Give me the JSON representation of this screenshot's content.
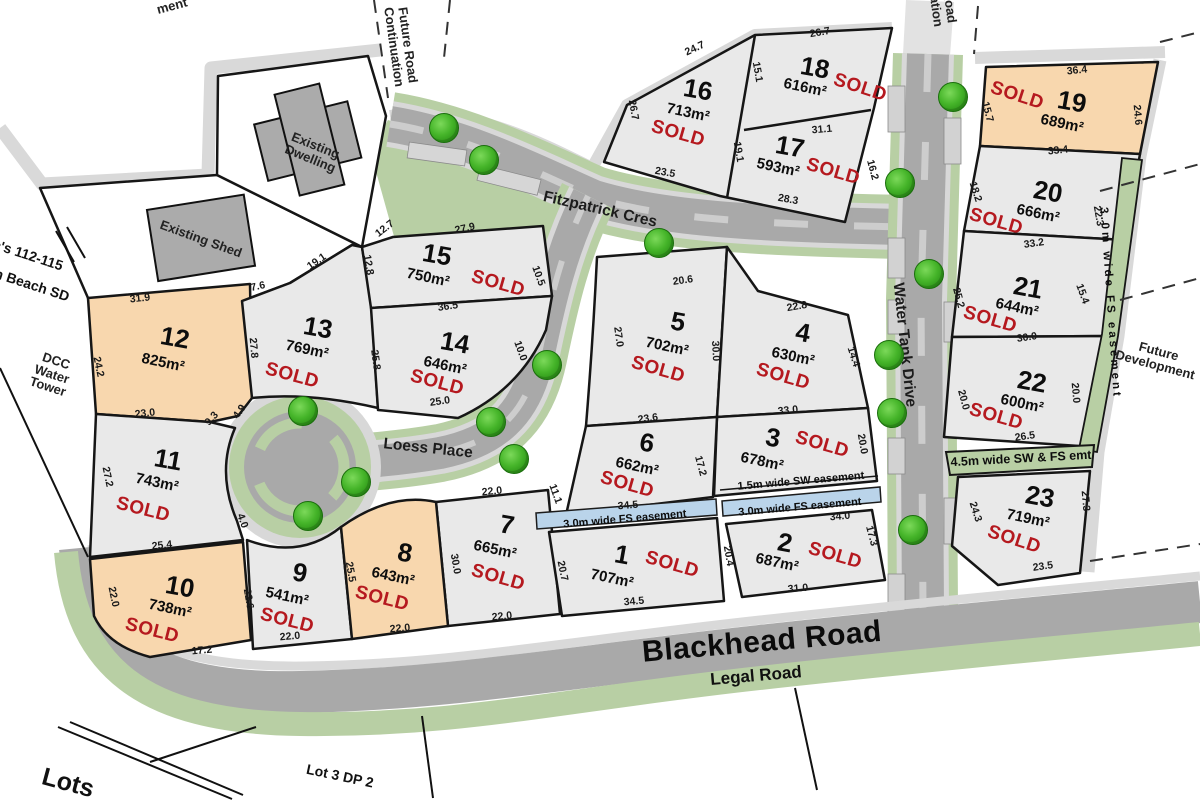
{
  "plan": {
    "sold_label": "SOLD",
    "colors": {
      "lot_grey": "#e9e9e9",
      "lot_orange": "#f8d7ae",
      "road_grey": "#a9a9a9",
      "verge_green": "#b8cfa4",
      "easement_blue": "#bad4ea",
      "sold_red": "#b5191f",
      "tree_green": "#46b52a",
      "boundary_band": "#d9d9d9"
    },
    "roads": [
      {
        "name": "fitzpatrick-cres",
        "label": "Fitzpatrick Cres",
        "x": 600,
        "y": 210,
        "r": 13,
        "cls": "road-md"
      },
      {
        "name": "loess-place",
        "label": "Loess Place",
        "x": 428,
        "y": 449,
        "r": 6,
        "cls": "road-md"
      },
      {
        "name": "water-tank-drive",
        "label": "Water Tank Drive",
        "x": 904,
        "y": 345,
        "r": 84,
        "cls": "road-md"
      },
      {
        "name": "blackhead-road",
        "label": "Blackhead Road",
        "x": 762,
        "y": 642,
        "r": -5,
        "cls": "road-xl"
      },
      {
        "name": "legal-road",
        "label": "Legal Road",
        "x": 756,
        "y": 676,
        "r": -5,
        "cls": "road-lg"
      }
    ],
    "lots": [
      {
        "num": "1",
        "area": "707m²",
        "sold": true,
        "color": "grey",
        "np": [
          622,
          555,
          10
        ],
        "ap": [
          612,
          579,
          12
        ],
        "sp": [
          672,
          565,
          16
        ]
      },
      {
        "num": "2",
        "area": "687m²",
        "sold": true,
        "color": "grey",
        "np": [
          785,
          543,
          10
        ],
        "ap": [
          777,
          563,
          12
        ],
        "sp": [
          835,
          556,
          16
        ]
      },
      {
        "num": "3",
        "area": "678m²",
        "sold": true,
        "color": "grey",
        "np": [
          773,
          438,
          10
        ],
        "ap": [
          762,
          462,
          12
        ],
        "sp": [
          822,
          445,
          16
        ]
      },
      {
        "num": "4",
        "area": "630m²",
        "sold": true,
        "color": "grey",
        "np": [
          803,
          333,
          10
        ],
        "ap": [
          793,
          357,
          12
        ],
        "sp": [
          783,
          377,
          16
        ]
      },
      {
        "num": "5",
        "area": "702m²",
        "sold": true,
        "color": "grey",
        "np": [
          678,
          322,
          10
        ],
        "ap": [
          667,
          347,
          12
        ],
        "sp": [
          658,
          370,
          16
        ]
      },
      {
        "num": "6",
        "area": "662m²",
        "sold": true,
        "color": "grey",
        "np": [
          647,
          443,
          10
        ],
        "ap": [
          637,
          467,
          12
        ],
        "sp": [
          627,
          485,
          16
        ]
      },
      {
        "num": "7",
        "area": "665m²",
        "sold": true,
        "color": "grey",
        "np": [
          507,
          525,
          10
        ],
        "ap": [
          495,
          550,
          12
        ],
        "sp": [
          498,
          578,
          16
        ]
      },
      {
        "num": "8",
        "area": "643m²",
        "sold": true,
        "color": "orange",
        "np": [
          405,
          553,
          10
        ],
        "ap": [
          393,
          577,
          12
        ],
        "sp": [
          382,
          599,
          14
        ]
      },
      {
        "num": "9",
        "area": "541m²",
        "sold": true,
        "color": "grey",
        "np": [
          300,
          573,
          10
        ],
        "ap": [
          287,
          597,
          12
        ],
        "sp": [
          287,
          621,
          14
        ]
      },
      {
        "num": "10",
        "area": "738m²",
        "sold": true,
        "color": "orange",
        "np": [
          180,
          587,
          10
        ],
        "ap": [
          170,
          609,
          12
        ],
        "sp": [
          152,
          631,
          14
        ]
      },
      {
        "num": "11",
        "area": "743m²",
        "sold": true,
        "color": "grey",
        "np": [
          168,
          460,
          10
        ],
        "ap": [
          157,
          483,
          12
        ],
        "sp": [
          143,
          510,
          14
        ]
      },
      {
        "num": "12",
        "area": "825m²",
        "sold": false,
        "color": "orange",
        "np": [
          175,
          338,
          10
        ],
        "ap": [
          163,
          363,
          12
        ],
        "sp": [
          0,
          0,
          0
        ]
      },
      {
        "num": "13",
        "area": "769m²",
        "sold": true,
        "color": "grey",
        "np": [
          318,
          328,
          10
        ],
        "ap": [
          307,
          350,
          12
        ],
        "sp": [
          292,
          376,
          15
        ]
      },
      {
        "num": "14",
        "area": "646m²",
        "sold": true,
        "color": "grey",
        "np": [
          455,
          343,
          10
        ],
        "ap": [
          445,
          366,
          12
        ],
        "sp": [
          437,
          383,
          15
        ]
      },
      {
        "num": "15",
        "area": "750m²",
        "sold": true,
        "color": "grey",
        "np": [
          437,
          255,
          10
        ],
        "ap": [
          428,
          278,
          12
        ],
        "sp": [
          498,
          284,
          16
        ]
      },
      {
        "num": "16",
        "area": "713m²",
        "sold": true,
        "color": "grey",
        "np": [
          698,
          90,
          10
        ],
        "ap": [
          688,
          113,
          12
        ],
        "sp": [
          678,
          134,
          16
        ]
      },
      {
        "num": "17",
        "area": "593m²",
        "sold": true,
        "color": "grey",
        "np": [
          790,
          147,
          10
        ],
        "ap": [
          778,
          168,
          12
        ],
        "sp": [
          833,
          172,
          16
        ]
      },
      {
        "num": "18",
        "area": "616m²",
        "sold": true,
        "color": "grey",
        "np": [
          815,
          68,
          10
        ],
        "ap": [
          805,
          88,
          12
        ],
        "sp": [
          860,
          88,
          18
        ]
      },
      {
        "num": "19",
        "area": "689m²",
        "sold": true,
        "color": "orange",
        "np": [
          1072,
          102,
          10
        ],
        "ap": [
          1062,
          124,
          12
        ],
        "sp": [
          1017,
          96,
          18
        ]
      },
      {
        "num": "20",
        "area": "666m²",
        "sold": true,
        "color": "grey",
        "np": [
          1048,
          192,
          10
        ],
        "ap": [
          1038,
          214,
          12
        ],
        "sp": [
          996,
          222,
          16
        ]
      },
      {
        "num": "21",
        "area": "644m²",
        "sold": true,
        "color": "grey",
        "np": [
          1028,
          288,
          10
        ],
        "ap": [
          1017,
          308,
          12
        ],
        "sp": [
          990,
          320,
          16
        ]
      },
      {
        "num": "22",
        "area": "600m²",
        "sold": true,
        "color": "grey",
        "np": [
          1032,
          382,
          10
        ],
        "ap": [
          1022,
          404,
          12
        ],
        "sp": [
          996,
          417,
          16
        ]
      },
      {
        "num": "23",
        "area": "719m²",
        "sold": true,
        "color": "grey",
        "np": [
          1040,
          497,
          10
        ],
        "ap": [
          1028,
          519,
          12
        ],
        "sp": [
          1014,
          540,
          18
        ]
      }
    ],
    "dims": [
      [
        "24.7",
        695,
        49,
        -25
      ],
      [
        "26.7",
        633,
        110,
        80
      ],
      [
        "23.5",
        665,
        173,
        10
      ],
      [
        "15.1",
        757,
        72,
        80
      ],
      [
        "26.7",
        820,
        33,
        -10
      ],
      [
        "31.1",
        822,
        130,
        -5
      ],
      [
        "19.1",
        738,
        152,
        80
      ],
      [
        "28.3",
        788,
        200,
        10
      ],
      [
        "16.2",
        872,
        170,
        75
      ],
      [
        "36.4",
        1077,
        71,
        -6
      ],
      [
        "15.7",
        987,
        112,
        75
      ],
      [
        "24.6",
        1137,
        115,
        85
      ],
      [
        "33.4",
        1058,
        151,
        -6
      ],
      [
        "18.2",
        975,
        192,
        72
      ],
      [
        "22.3",
        1098,
        216,
        80
      ],
      [
        "33.2",
        1034,
        244,
        -8
      ],
      [
        "25.2",
        958,
        298,
        75
      ],
      [
        "15.4",
        1082,
        294,
        70
      ],
      [
        "30.0",
        1027,
        338,
        -8
      ],
      [
        "20.0",
        963,
        400,
        75
      ],
      [
        "20.0",
        1075,
        393,
        85
      ],
      [
        "26.5",
        1025,
        437,
        -8
      ],
      [
        "24.3",
        975,
        512,
        72
      ],
      [
        "27.3",
        1085,
        501,
        85
      ],
      [
        "23.5",
        1043,
        567,
        -8
      ],
      [
        "31.9",
        140,
        299,
        -6
      ],
      [
        "24.2",
        98,
        367,
        78
      ],
      [
        "23.0",
        145,
        414,
        -6
      ],
      [
        "9.3",
        212,
        419,
        -48
      ],
      [
        "4.9",
        240,
        412,
        -55
      ],
      [
        "27.8",
        253,
        348,
        85
      ],
      [
        "7.6",
        258,
        287,
        -12
      ],
      [
        "19.1",
        317,
        262,
        -35
      ],
      [
        "12.8",
        368,
        265,
        80
      ],
      [
        "25.8",
        375,
        360,
        82
      ],
      [
        "27.9",
        465,
        229,
        -12
      ],
      [
        "12.7",
        385,
        229,
        -38
      ],
      [
        "10.5",
        538,
        276,
        70
      ],
      [
        "36.5",
        448,
        307,
        -8
      ],
      [
        "10.0",
        520,
        351,
        70
      ],
      [
        "25.0",
        440,
        402,
        -8
      ],
      [
        "20.6",
        683,
        281,
        -8
      ],
      [
        "27.0",
        618,
        337,
        82
      ],
      [
        "30.0",
        715,
        351,
        87
      ],
      [
        "22.8",
        797,
        307,
        -10
      ],
      [
        "14.4",
        853,
        357,
        72
      ],
      [
        "33.0",
        788,
        411,
        -6
      ],
      [
        "20.0",
        862,
        444,
        80
      ],
      [
        "23.6",
        648,
        419,
        -8
      ],
      [
        "17.2",
        700,
        466,
        75
      ],
      [
        "34.5",
        628,
        506,
        -5
      ],
      [
        "22.0",
        492,
        492,
        -6
      ],
      [
        "30.0",
        455,
        564,
        80
      ],
      [
        "22.0",
        502,
        617,
        -6
      ],
      [
        "11.1",
        555,
        494,
        70
      ],
      [
        "20.7",
        562,
        571,
        78
      ],
      [
        "34.5",
        634,
        602,
        -5
      ],
      [
        "34.0",
        840,
        517,
        -5
      ],
      [
        "31.0",
        798,
        589,
        -5
      ],
      [
        "20.4",
        728,
        556,
        80
      ],
      [
        "17.3",
        871,
        536,
        75
      ],
      [
        "27.2",
        107,
        477,
        78
      ],
      [
        "25.4",
        162,
        546,
        -6
      ],
      [
        "4.0",
        242,
        521,
        70
      ],
      [
        "22.0",
        113,
        597,
        78
      ],
      [
        "17.2",
        202,
        651,
        -5
      ],
      [
        "22.6",
        248,
        599,
        80
      ],
      [
        "22.0",
        290,
        637,
        -5
      ],
      [
        "25.5",
        350,
        572,
        80
      ],
      [
        "22.0",
        400,
        629,
        -5
      ]
    ],
    "easements": [
      {
        "label": "1.5m wide SW easement",
        "x": 801,
        "y": 482,
        "r": -5,
        "cls": "ease"
      },
      {
        "label": "3.0m wide FS easement",
        "x": 625,
        "y": 520,
        "r": -5,
        "cls": "ease"
      },
      {
        "label": "3.0m wide FS easement",
        "x": 800,
        "y": 508,
        "r": -5,
        "cls": "ease"
      },
      {
        "label": "3.0m wide FS easement",
        "x": 1110,
        "y": 303,
        "r": 86,
        "cls": "ease ease-vert"
      },
      {
        "label": "4.5m wide SW & FS emt",
        "x": 1021,
        "y": 459,
        "r": -3,
        "cls": "ease ease-lg"
      }
    ],
    "annotations": [
      {
        "name": "existing-dwelling-label",
        "label": "Existing Dwelling",
        "x": 313,
        "y": 152,
        "r": 22,
        "cls": "ann wrap90"
      },
      {
        "name": "existing-shed-label",
        "label": "Existing Shed",
        "x": 201,
        "y": 239,
        "r": 20,
        "cls": "ann"
      },
      {
        "name": "future-road-continuation-top",
        "label": "Future Road Continuation",
        "x": 401,
        "y": 46,
        "r": 82,
        "cls": "ann wrap80"
      },
      {
        "name": "future-road-continuation-right",
        "label": "Future Road Continuation",
        "x": 940,
        "y": -14,
        "r": 82,
        "cls": "ann wrap80"
      },
      {
        "name": "future-development-label",
        "label": "Future Development",
        "x": 1157,
        "y": 358,
        "r": 15,
        "cls": "ann wrap80"
      },
      {
        "name": "dcc-water-tower-label",
        "label": "DCC Water Tower",
        "x": 52,
        "y": 374,
        "r": 18,
        "cls": "ann wrap50"
      },
      {
        "name": "boundary-ref-line1",
        "label": "c's 112-115",
        "x": 28,
        "y": 255,
        "r": 18,
        "cls": "ann-bold"
      },
      {
        "name": "boundary-ref-line2",
        "label": "n Beach SD",
        "x": 32,
        "y": 285,
        "r": 18,
        "cls": "ann-bold"
      },
      {
        "name": "easement-partial-label",
        "label": "ment",
        "x": 172,
        "y": 6,
        "r": -15,
        "cls": "ann"
      },
      {
        "name": "lots-partial-label",
        "label": "Lots",
        "x": 68,
        "y": 783,
        "r": 15,
        "cls": "ann-xl"
      },
      {
        "name": "lot-3-dp-label",
        "label": "Lot 3 DP 2",
        "x": 340,
        "y": 776,
        "r": 12,
        "cls": "ann-bold"
      }
    ],
    "trees": [
      [
        443,
        127
      ],
      [
        483,
        159
      ],
      [
        658,
        242
      ],
      [
        952,
        96
      ],
      [
        899,
        182
      ],
      [
        928,
        273
      ],
      [
        888,
        354
      ],
      [
        891,
        412
      ],
      [
        912,
        529
      ],
      [
        546,
        364
      ],
      [
        490,
        421
      ],
      [
        513,
        458
      ],
      [
        302,
        410
      ],
      [
        355,
        481
      ],
      [
        307,
        515
      ]
    ]
  }
}
